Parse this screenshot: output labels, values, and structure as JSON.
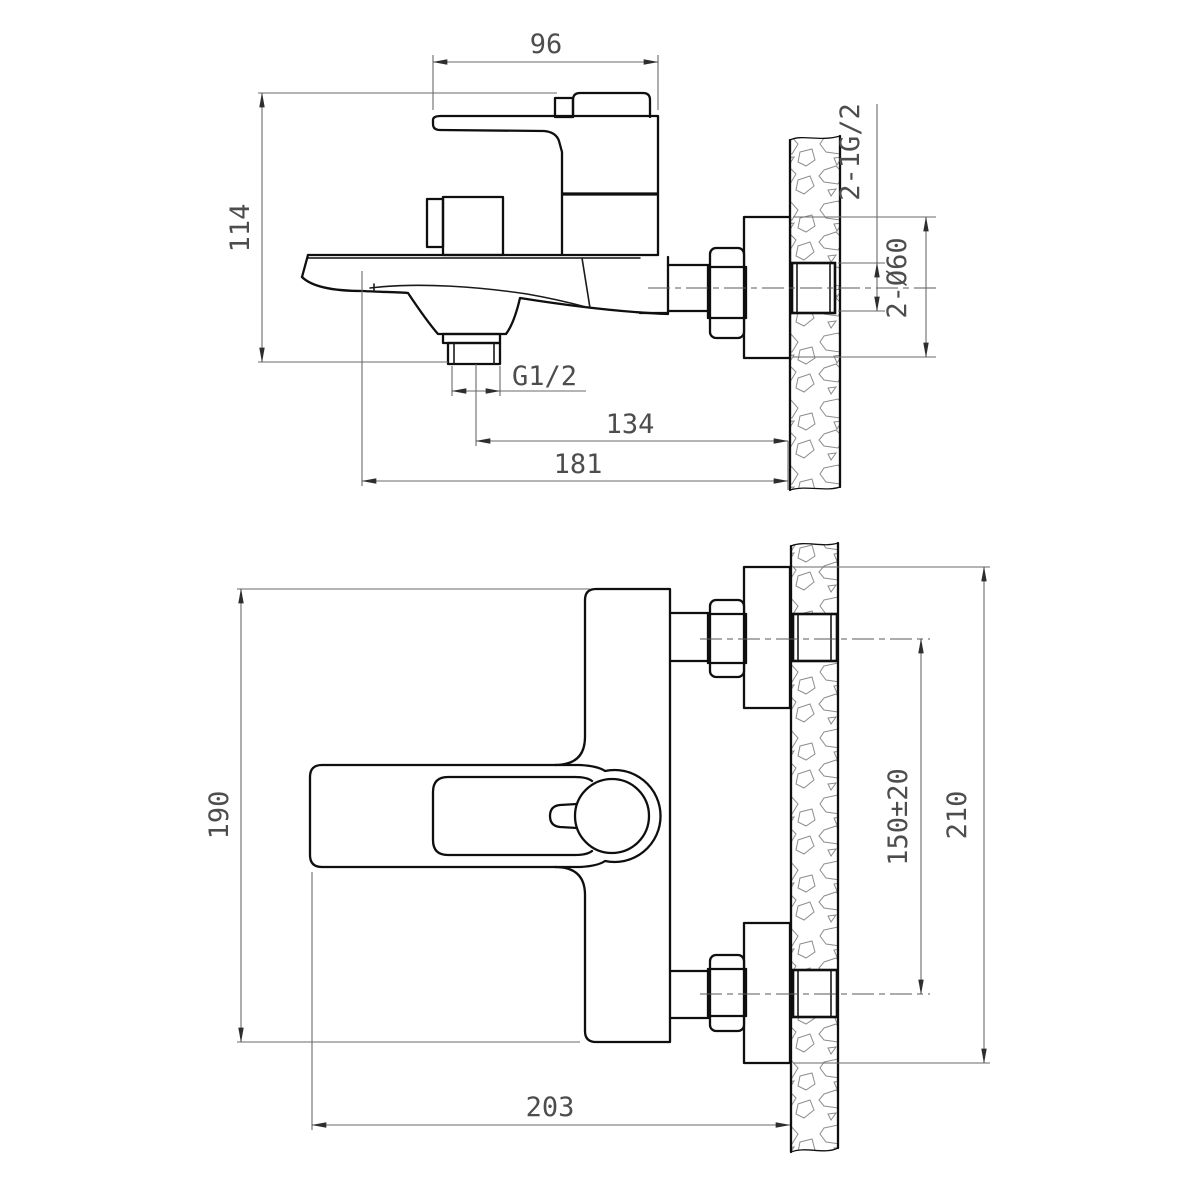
{
  "drawing": {
    "type": "technical-dimension-drawing",
    "subject": "wall-mounted bath mixer faucet, two orthographic views with wall section",
    "units_implied": "mm",
    "side_view": {
      "dims": {
        "top_width": "96",
        "overall_height": "114",
        "outlet_thread": "G1/2",
        "outlet_center_to_wall": "134",
        "spout_tip_to_wall": "181",
        "inlet_threads": "2-1G/2",
        "escutcheon_diameter": "2-Ø60"
      }
    },
    "front_view": {
      "dims": {
        "body_height": "190",
        "overall_width": "203",
        "inlet_spacing": "150±20",
        "escutcheon_span": "210"
      }
    },
    "colors": {
      "object_line": "#0f0f0f",
      "dimension_line": "#6a6a6a",
      "hatch": "#8c8c8c",
      "background": "#ffffff"
    }
  }
}
